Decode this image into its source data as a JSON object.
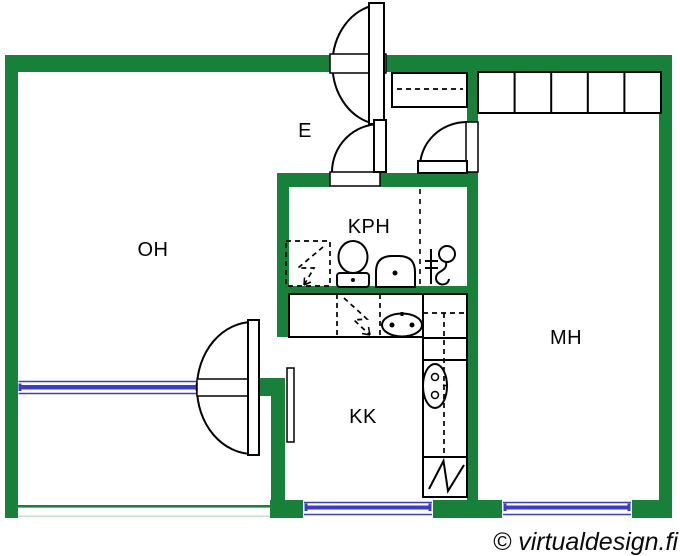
{
  "watermark": "© virtualdesign.fi",
  "colors": {
    "wall": "#17813a",
    "window": "#3b3bd0",
    "outline": "#000000",
    "background": "#ffffff"
  },
  "rooms": {
    "oh": {
      "label": "OH"
    },
    "e": {
      "label": "E"
    },
    "kph": {
      "label": "KPH"
    },
    "kk": {
      "label": "KK"
    },
    "mh": {
      "label": "MH"
    }
  },
  "fixtures": [
    "entrance-door",
    "kph-door",
    "mh-door",
    "balcony-door",
    "window",
    "wardrobe",
    "washing-machine-reservation",
    "toilet",
    "washbasin",
    "shower",
    "kitchen-counter",
    "dishwasher-reservation",
    "kitchen-sink",
    "stove",
    "refrigerator"
  ]
}
